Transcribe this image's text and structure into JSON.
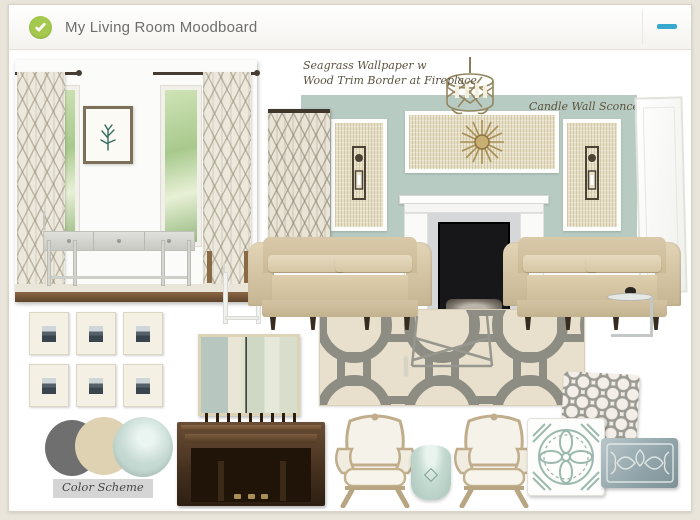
{
  "window": {
    "title": "My Living Room Moodboard"
  },
  "header_icons": {
    "status": "checkmark-icon",
    "minimize": "minimize-icon"
  },
  "annotations": {
    "wallpaper_note_line1": "Seagrass Wallpaper w",
    "wallpaper_note_line2": "Wood Trim Border at Fireplace",
    "sconce_label": "Candle Wall Sconce",
    "color_scheme_label": "Color Scheme"
  },
  "palette": {
    "accent_green": "#a5c94e",
    "minimize_blue": "#38a8cf",
    "canvas_beige": "#e9e5da",
    "wall_sage": "#b7cbc2",
    "seagrass_cream": "#e6dfc4",
    "sofa_beige": "#d9c9aa",
    "rug_cream": "#e8e0cc",
    "rug_gray": "#8e8d84",
    "piano_brown": "#6b4e36",
    "swatch_gray": "#6f6f6f",
    "swatch_cream": "#ded2b3",
    "swatch_seafoam": "#c7dbd4"
  },
  "moodboard": {
    "items": [
      "console-table-vignette-photo",
      "trellis-curtain-panel",
      "sage-accent-wall",
      "seagrass-wallpaper-panels",
      "candle-wall-sconces",
      "sunburst-mirror",
      "drum-cage-chandelier",
      "white-fireplace-mantel",
      "white-door-panel",
      "beige-sofa-pair",
      "geometric-trellis-rug",
      "x-base-coffee-table",
      "gallery-frame-grid",
      "abstract-striped-art",
      "color-scheme-swatches",
      "upright-piano-with-bench",
      "bergere-armchair-pair",
      "ceramic-garden-stool",
      "trellis-pillow",
      "medallion-pillow",
      "damask-lumbar-pillow",
      "chrome-c-table",
      "white-side-table"
    ]
  }
}
